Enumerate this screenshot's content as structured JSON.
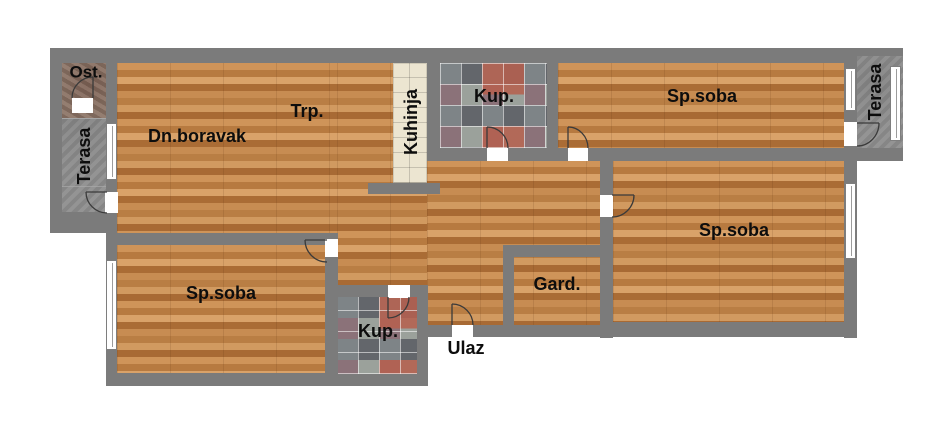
{
  "plan": {
    "type": "apartment-floor-plan",
    "rooms": {
      "ost": "Ost.",
      "terasa_left": "Terasa",
      "dn_boravak": "Dn.boravak",
      "trp": "Trp.",
      "kuhinja": "Kuhinja",
      "kup_top": "Kup.",
      "sp_soba_top_right": "Sp.soba",
      "terasa_right": "Terasa",
      "sp_soba_bottom_right": "Sp.soba",
      "gard": "Gard.",
      "sp_soba_bottom_left": "Sp.soba",
      "kup_bottom": "Kup.",
      "ulaz": "Ulaz"
    },
    "palette": {
      "wall": "#7b7b7b",
      "wood": "#c08450",
      "terrace": "#8e8e8e",
      "ost_floor": "#8c7466",
      "kitchen_tile": "#ece5d1",
      "mosaic_base": "#8f8f8c",
      "mosaic_dark": "#63666b",
      "mosaic_light": "#9ba19b",
      "mosaic_red": "#b65f4d",
      "mosaic_mauve": "#8b7279",
      "label": "#0d0d0d",
      "background": "#ffffff"
    }
  }
}
